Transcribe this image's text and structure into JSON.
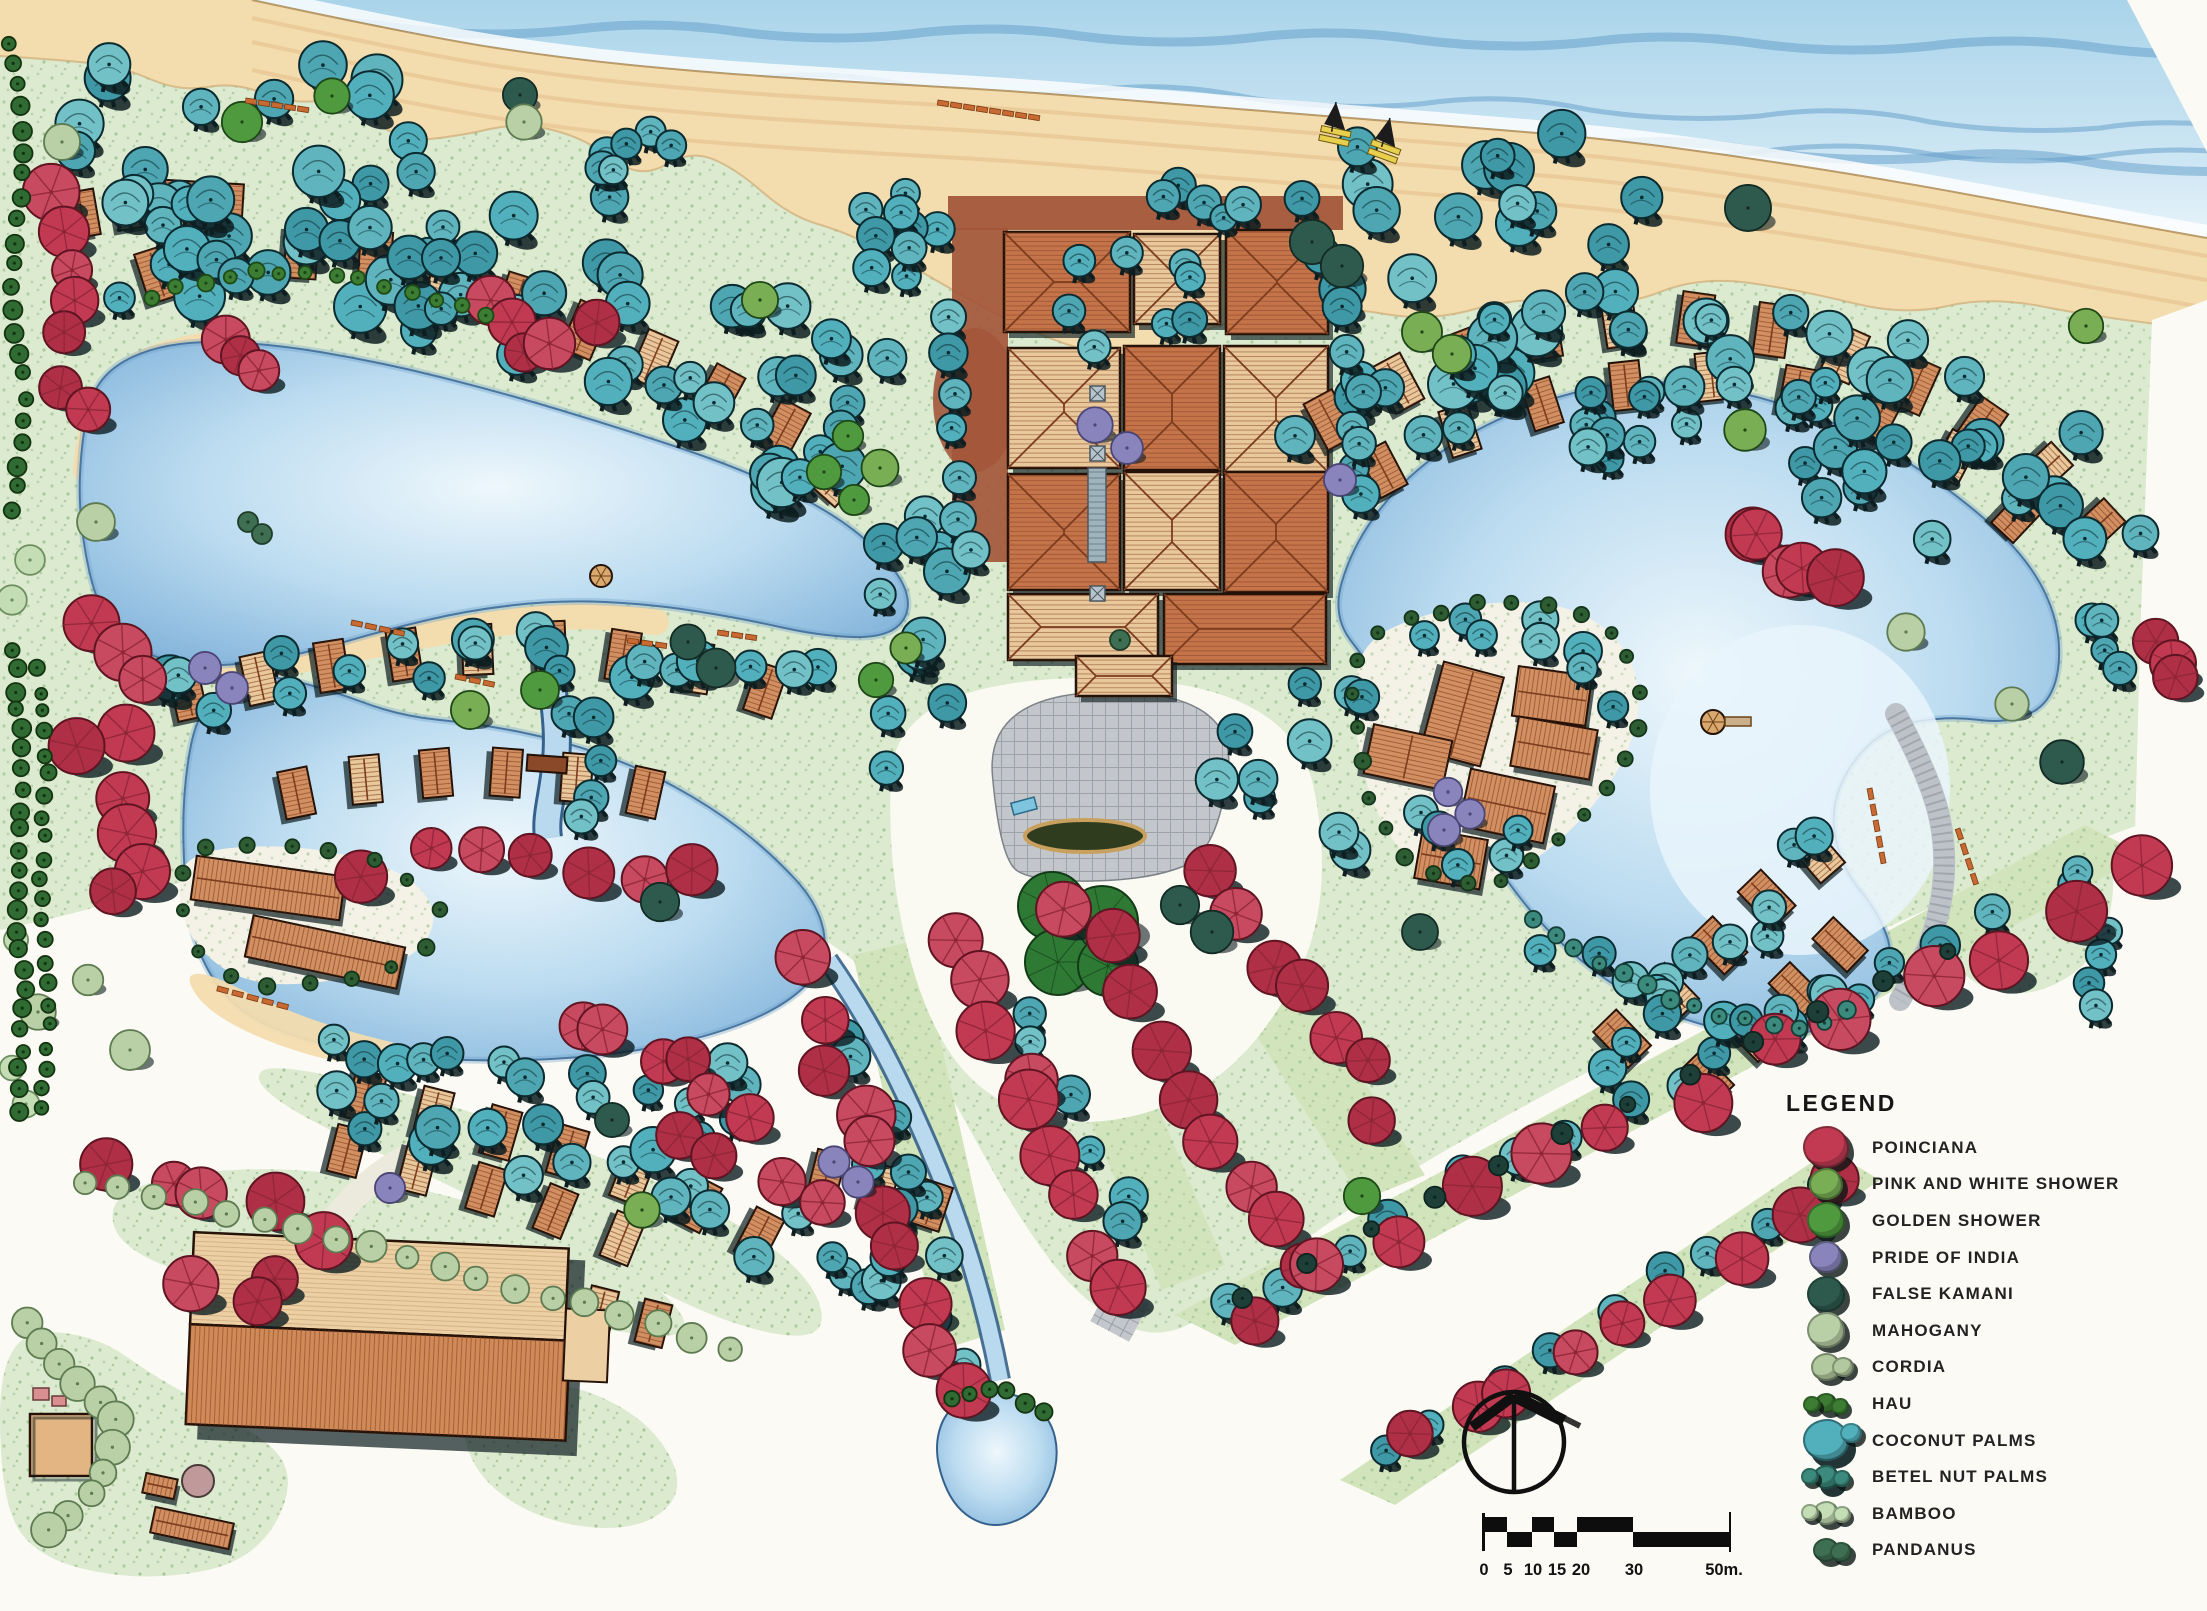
{
  "legend": {
    "title": "LEGEND",
    "items": [
      {
        "id": "poinciana",
        "label": "POINCIANA",
        "color": "#c23a52"
      },
      {
        "id": "pink-and-white-shower",
        "label": "PINK AND WHITE SHOWER",
        "color": "#79ae54"
      },
      {
        "id": "golden-shower",
        "label": "GOLDEN SHOWER",
        "color": "#4f9a3e"
      },
      {
        "id": "pride-of-india",
        "label": "PRIDE OF INDIA",
        "color": "#8a84bd"
      },
      {
        "id": "false-kamani",
        "label": "FALSE KAMANI",
        "color": "#2e5a4e"
      },
      {
        "id": "mahogany",
        "label": "MAHOGANY",
        "color": "#b9cfa6"
      },
      {
        "id": "cordia",
        "label": "CORDIA",
        "color": "#b2c89e"
      },
      {
        "id": "hau",
        "label": "HAU",
        "color": "#3c7d33"
      },
      {
        "id": "coconut-palms",
        "label": "COCONUT PALMS",
        "color": "#52b0bd"
      },
      {
        "id": "betel-nut-palms",
        "label": "BETEL NUT PALMS",
        "color": "#3b8a7d"
      },
      {
        "id": "bamboo",
        "label": "BAMBOO",
        "color": "#c4ddb4"
      },
      {
        "id": "pandanus",
        "label": "PANDANUS",
        "color": "#3f6f52"
      }
    ]
  },
  "scale_bar": {
    "labels": [
      "0",
      "5",
      "10",
      "15",
      "20",
      "30",
      "50m."
    ]
  },
  "palette": {
    "paper": "#fbfaf4",
    "lawn": "#dcead0",
    "lawn2": "#d2e4bc",
    "stipple": "#98bf8a",
    "sand": "#f3dcae",
    "sand_line": "#c79c62",
    "ocean": "#b7dcee",
    "ocean_light": "#e2f1f8",
    "wave": "#5f9cc8",
    "lagoon_edge": "#7fb2da",
    "lagoon_mid": "#bcdcf0",
    "lagoon_light": "#ecf6fc",
    "roof": "#d29062",
    "roof_light": "#e9c89c",
    "roof_dark": "#c5744a",
    "roof_line": "#7c3c1e",
    "outline": "#241107",
    "drive": "#a3563a",
    "plaza": "#c3c7cb",
    "plaza_line": "#8e949c",
    "pool_dark": "#2f3d1e",
    "pool_rim": "#c9a05e",
    "palm_stroke": "#0c2b30",
    "shadow": "#0d1d20",
    "red_line": "#8e2638",
    "red_stroke": "#5f1422",
    "lounger": "#c86a32",
    "boat_hull": "#e8cf4e"
  }
}
